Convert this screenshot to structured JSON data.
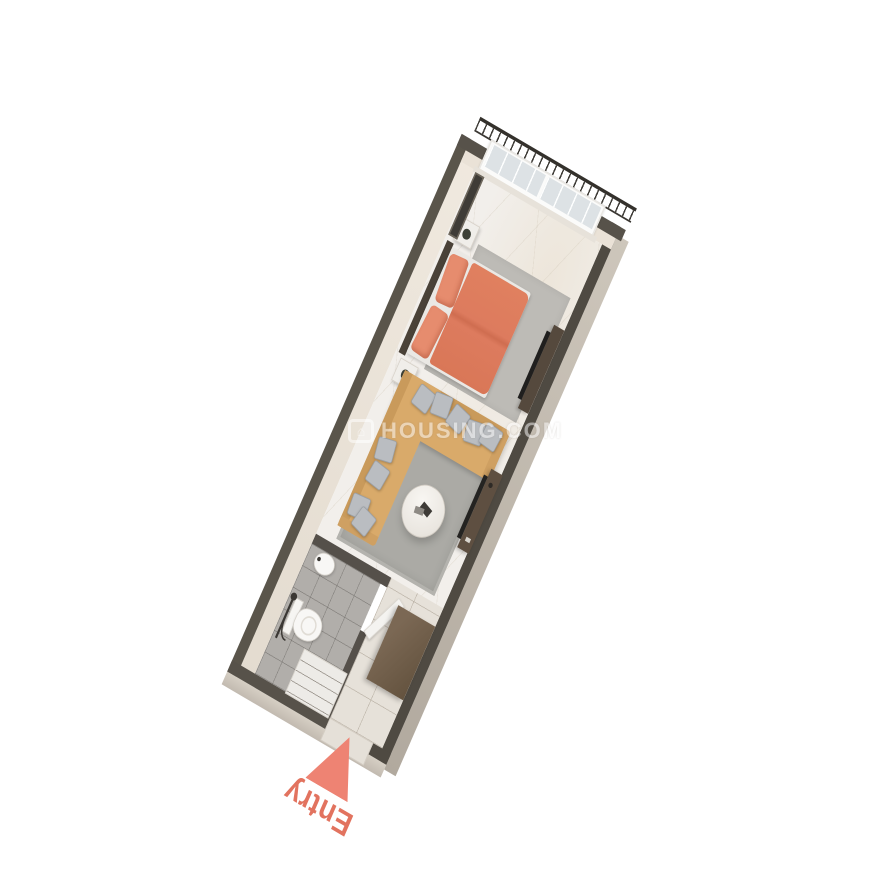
{
  "scene": {
    "description": "3D isometric render of a narrow studio apartment floor plan on a plain background",
    "background_color": "#ffffff"
  },
  "labels": {
    "entry": "Entry"
  },
  "watermark": {
    "icon_glyph": "⌂",
    "text": "HOUSING.COM"
  },
  "colors": {
    "accent_coral": "#ee8373",
    "bed_duvet": "#dd7b5e",
    "sofa_tan": "#d9aa6a",
    "cushion_gray": "#babdc1",
    "wall_cap_dark": "#57524a",
    "wall_face_interior": "#ece4da",
    "wall_face_exterior": "#b9b1a6",
    "floor_marble": "#f2efeb",
    "floor_bathroom_tile": "#b1aeaa",
    "floor_hall_tile": "#e6e1d9",
    "wood_dark": "#55493d",
    "wardrobe_brown": "#6e5b48",
    "railing_metal": "#34312c"
  },
  "rooms": {
    "balcony": {
      "items": [
        "ornamental-railing",
        "sliding-window"
      ]
    },
    "bedroom": {
      "items": [
        "double-bed",
        "coral-duvet",
        "two-pillows",
        "nightstand-left",
        "nightstand-right",
        "gray-rug",
        "tv-panel",
        "wall-tv-unit"
      ]
    },
    "living_area": {
      "items": [
        "l-shaped-sofa",
        "gray-cushions",
        "round-coffee-table",
        "gray-rug",
        "tv-console"
      ]
    },
    "bathroom": {
      "items": [
        "washbasin",
        "toilet",
        "shower-set",
        "open-door",
        "gray-tile-floor"
      ]
    },
    "entry_hall": {
      "items": [
        "wardrobe",
        "shoe-cabinet",
        "beige-tile-floor",
        "entry-arrow"
      ]
    }
  }
}
